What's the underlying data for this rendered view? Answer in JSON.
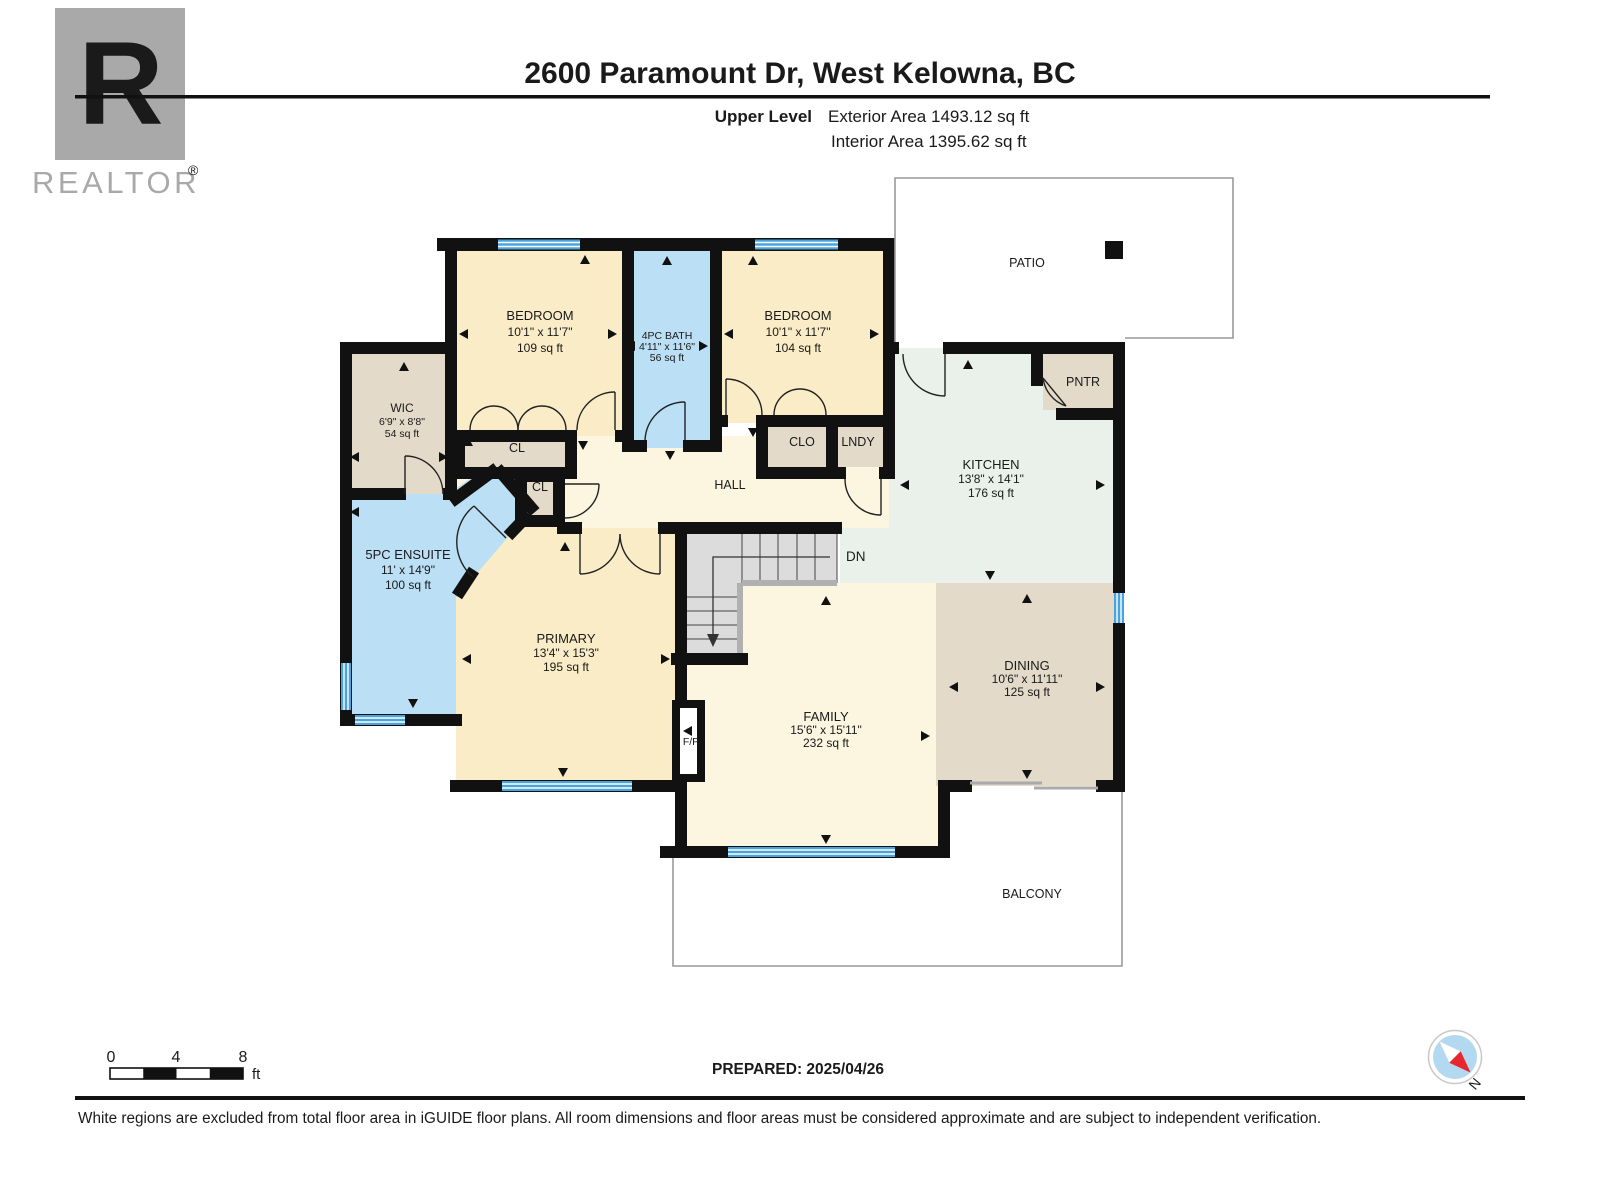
{
  "header": {
    "title": "2600 Paramount Dr, West Kelowna, BC",
    "level_label": "Upper Level",
    "exterior_area": "Exterior Area 1493.12 sq ft",
    "interior_area": "Interior Area 1395.62 sq ft"
  },
  "logo": {
    "letter": "R",
    "wordmark": "REALTOR",
    "registered": "®"
  },
  "plan": {
    "rooms": {
      "bedroom1": {
        "name": "BEDROOM",
        "dims": "10'1\" x 11'7\"",
        "area": "109 sq ft"
      },
      "bath": {
        "name": "4PC BATH",
        "dims": "4'11\" x 11'6\"",
        "area": "56 sq ft"
      },
      "bedroom2": {
        "name": "BEDROOM",
        "dims": "10'1\" x 11'7\"",
        "area": "104 sq ft"
      },
      "wic": {
        "name": "WIC",
        "dims": "6'9\" x 8'8\"",
        "area": "54 sq ft"
      },
      "ensuite": {
        "name": "5PC ENSUITE",
        "dims": "11' x 14'9\"",
        "area": "100 sq ft"
      },
      "primary": {
        "name": "PRIMARY",
        "dims": "13'4\" x 15'3\"",
        "area": "195 sq ft"
      },
      "kitchen": {
        "name": "KITCHEN",
        "dims": "13'8\" x 14'1\"",
        "area": "176 sq ft"
      },
      "dining": {
        "name": "DINING",
        "dims": "10'6\" x 11'11\"",
        "area": "125 sq ft"
      },
      "family": {
        "name": "FAMILY",
        "dims": "15'6\" x 15'11\"",
        "area": "232 sq ft"
      },
      "hall": {
        "name": "HALL"
      },
      "cl1": {
        "name": "CL"
      },
      "cl2": {
        "name": "CL"
      },
      "clo": {
        "name": "CLO"
      },
      "lndy": {
        "name": "LNDY"
      },
      "pntr": {
        "name": "PNTR"
      },
      "patio": {
        "name": "PATIO"
      },
      "balcony": {
        "name": "BALCONY"
      },
      "fireplace": {
        "name": "F/P"
      },
      "stairs_down": {
        "name": "DN"
      }
    }
  },
  "scale_bar": {
    "ticks": [
      "0",
      "4",
      "8"
    ],
    "unit": "ft"
  },
  "prepared": "PREPARED: 2025/04/26",
  "compass": {
    "north_label": "N"
  },
  "footer": {
    "disclaimer": "White regions are excluded from total floor area in iGUIDE floor plans. All room dimensions and floor areas must be considered approximate and are subject to independent verification."
  },
  "colors": {
    "wall": "#111111",
    "bedroom_fill": "#FAECC7",
    "hall_fill": "#FCF6E1",
    "bath_fill": "#BBDFF4",
    "closet_fill": "#E3DACA",
    "kitchen_fill": "#E9F1EA",
    "window_blue": "#4AA4DC",
    "stairs_fill": "#DCDCDC",
    "compass_blue": "#B3D9F0",
    "compass_red": "#E8262D",
    "logo_gray": "#A9A9A9"
  }
}
